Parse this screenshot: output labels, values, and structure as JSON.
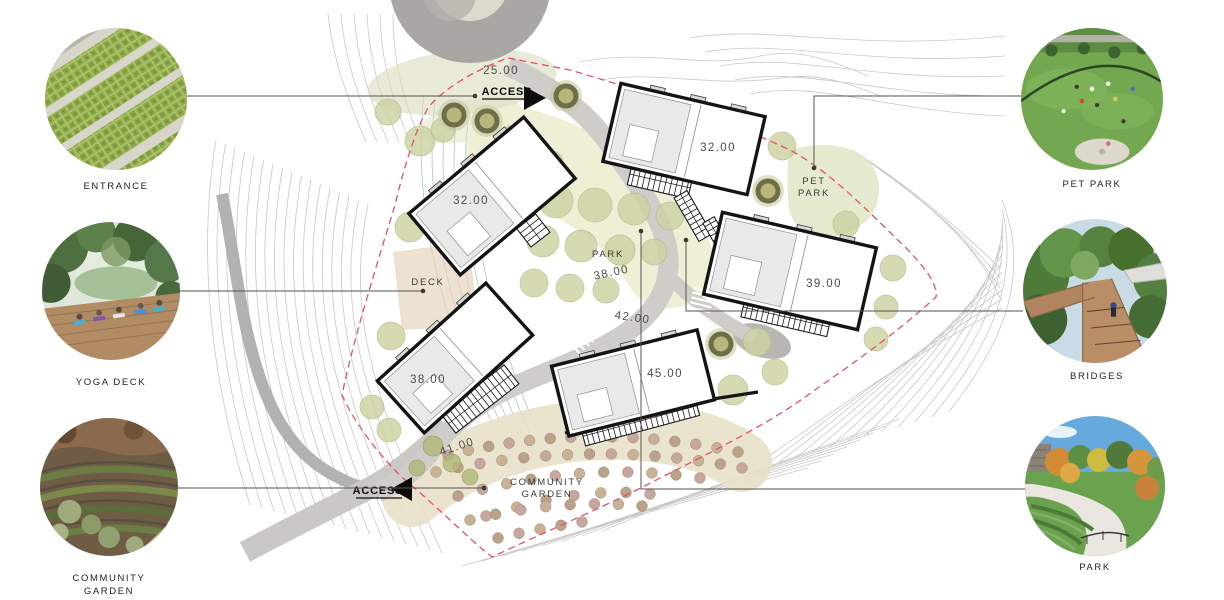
{
  "legend_left": [
    {
      "label": "ENTRANCE"
    },
    {
      "label": "YOGA DECK"
    },
    {
      "label": "COMMUNITY GARDEN"
    }
  ],
  "legend_right": [
    {
      "label": "PET PARK"
    },
    {
      "label": "BRIDGES"
    },
    {
      "label": "PARK"
    }
  ],
  "plan": {
    "elevations": [
      {
        "text": "25.00",
        "x": 501,
        "y": 74
      },
      {
        "text": "32.00",
        "x": 471,
        "y": 204
      },
      {
        "text": "32.00",
        "x": 718,
        "y": 151
      },
      {
        "text": "39.00",
        "x": 824,
        "y": 287
      },
      {
        "text": "38.00",
        "x": 428,
        "y": 383
      },
      {
        "text": "45.00",
        "x": 665,
        "y": 377
      }
    ],
    "road_labels": [
      {
        "text": "38.00",
        "x": 612,
        "y": 276,
        "rot": -12
      },
      {
        "text": "42.00",
        "x": 632,
        "y": 321,
        "rot": 8
      },
      {
        "text": "41.00",
        "x": 458,
        "y": 450,
        "rot": -18
      }
    ],
    "place_labels": [
      {
        "text": "PARK",
        "x": 608,
        "y": 257
      },
      {
        "text": "DECK",
        "x": 428,
        "y": 285
      },
      {
        "text": "PET",
        "x": 814,
        "y": 184
      },
      {
        "text": "PARK",
        "x": 814,
        "y": 196
      },
      {
        "text": "COMMUNITY",
        "x": 547,
        "y": 485
      },
      {
        "text": "GARDEN",
        "x": 547,
        "y": 497
      }
    ],
    "access_labels": [
      {
        "text": "ACCESS",
        "x": 507,
        "y": 95,
        "dir": "right"
      },
      {
        "text": "ACCESS",
        "x": 378,
        "y": 494,
        "dir": "left"
      }
    ]
  },
  "colors": {
    "boundary_dashed": "#E8506A",
    "road": "#CECDC9",
    "road_dark": "#B2B2B0",
    "tree_green": "#CCD3A2",
    "contour_gray": "#C8C8C6",
    "contour_teal": "#96C1B8",
    "leader_line": "#56524C"
  }
}
